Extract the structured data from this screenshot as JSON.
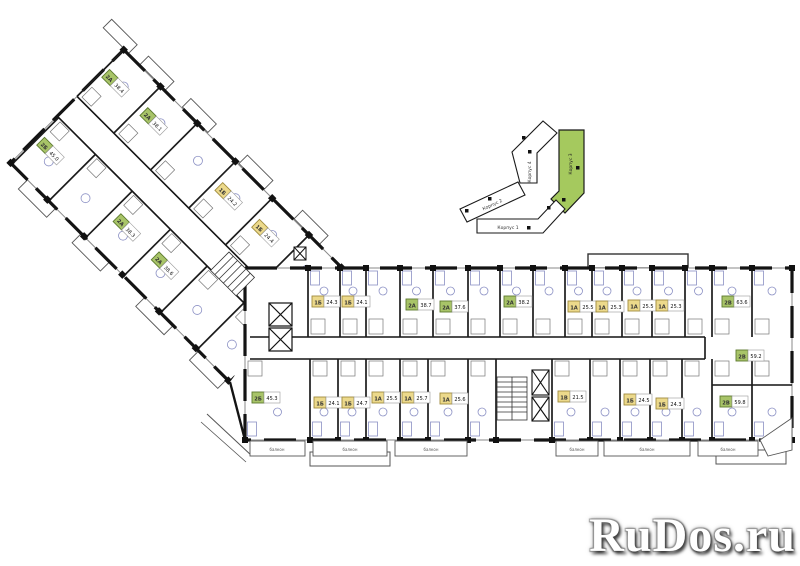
{
  "page": {
    "background": "#ffffff"
  },
  "watermark": {
    "text": "RuDos.ru",
    "color": "#ffffff",
    "shadow_color": "#3c3c3c"
  },
  "site_map": {
    "buildings": [
      {
        "id": "korpus-1",
        "label": "Корпус 1",
        "highlighted": false
      },
      {
        "id": "korpus-2",
        "label": "Корпус 2",
        "highlighted": false
      },
      {
        "id": "korpus-3",
        "label": "Корпус 3",
        "highlighted": true
      },
      {
        "id": "korpus-4",
        "label": "Корпус 4",
        "highlighted": false
      }
    ],
    "highlight_color": "#a5c95e",
    "outline_color": "#1a1a1a"
  },
  "unit_colors": {
    "1": {
      "fill": "#ecd98b",
      "border": "#a08c3e"
    },
    "2": {
      "fill": "#a8c468",
      "border": "#5c7a2e"
    }
  },
  "labels": {
    "balcony": "балкон"
  },
  "units": [
    {
      "wing": "main-top",
      "type": "1Б",
      "area": "24.3",
      "cat": "1",
      "x": 312,
      "y": 296
    },
    {
      "wing": "main-top",
      "type": "1Б",
      "area": "24.1",
      "cat": "1",
      "x": 342,
      "y": 296
    },
    {
      "wing": "main-top",
      "type": "2А",
      "area": "38.7",
      "cat": "2",
      "x": 406,
      "y": 299
    },
    {
      "wing": "main-top",
      "type": "2А",
      "area": "37.6",
      "cat": "2",
      "x": 440,
      "y": 301
    },
    {
      "wing": "main-top",
      "type": "2А",
      "area": "38.2",
      "cat": "2",
      "x": 504,
      "y": 296
    },
    {
      "wing": "main-top",
      "type": "1А",
      "area": "25.5",
      "cat": "1",
      "x": 568,
      "y": 301
    },
    {
      "wing": "main-top",
      "type": "1А",
      "area": "25.3",
      "cat": "1",
      "x": 596,
      "y": 301
    },
    {
      "wing": "main-top",
      "type": "1А",
      "area": "25.5",
      "cat": "1",
      "x": 628,
      "y": 300
    },
    {
      "wing": "main-top",
      "type": "1А",
      "area": "25.3",
      "cat": "1",
      "x": 656,
      "y": 300
    },
    {
      "wing": "main-top",
      "type": "2В",
      "area": "63.6",
      "cat": "2",
      "x": 722,
      "y": 296
    },
    {
      "wing": "main-bottom",
      "type": "2Б",
      "area": "45.3",
      "cat": "2",
      "x": 252,
      "y": 392
    },
    {
      "wing": "main-bottom",
      "type": "1Б",
      "area": "24.1",
      "cat": "1",
      "x": 314,
      "y": 397
    },
    {
      "wing": "main-bottom",
      "type": "1Б",
      "area": "24.7",
      "cat": "1",
      "x": 342,
      "y": 397
    },
    {
      "wing": "main-bottom",
      "type": "1А",
      "area": "25.5",
      "cat": "1",
      "x": 372,
      "y": 392
    },
    {
      "wing": "main-bottom",
      "type": "1А",
      "area": "25.7",
      "cat": "1",
      "x": 402,
      "y": 392
    },
    {
      "wing": "main-bottom",
      "type": "1А",
      "area": "25.6",
      "cat": "1",
      "x": 440,
      "y": 393
    },
    {
      "wing": "main-bottom",
      "type": "1В",
      "area": "21.5",
      "cat": "1",
      "x": 558,
      "y": 391
    },
    {
      "wing": "main-bottom",
      "type": "1Б",
      "area": "24.5",
      "cat": "1",
      "x": 624,
      "y": 394
    },
    {
      "wing": "main-bottom",
      "type": "1Б",
      "area": "24.3",
      "cat": "1",
      "x": 656,
      "y": 398
    },
    {
      "wing": "main-bottom",
      "type": "2В",
      "area": "59.2",
      "cat": "2",
      "x": 736,
      "y": 350
    },
    {
      "wing": "main-bottom",
      "type": "2В",
      "area": "59.8",
      "cat": "2",
      "x": 720,
      "y": 396
    },
    {
      "wing": "angled",
      "type": "2А",
      "area": "38.4",
      "cat": "2",
      "x": -36,
      "y": 24
    },
    {
      "wing": "angled",
      "type": "2А",
      "area": "38.1",
      "cat": "2",
      "x": 18,
      "y": 24
    },
    {
      "wing": "angled",
      "type": "1Б",
      "area": "24.2",
      "cat": "1",
      "x": 124,
      "y": 24
    },
    {
      "wing": "angled",
      "type": "1Б",
      "area": "24.4",
      "cat": "1",
      "x": 176,
      "y": 24
    },
    {
      "wing": "angled",
      "type": "2Б",
      "area": "45.0",
      "cat": "2",
      "x": -34,
      "y": 118
    },
    {
      "wing": "angled",
      "type": "2А",
      "area": "38.3",
      "cat": "2",
      "x": 74,
      "y": 118
    },
    {
      "wing": "angled",
      "type": "2А",
      "area": "38.6",
      "cat": "2",
      "x": 128,
      "y": 118
    }
  ]
}
